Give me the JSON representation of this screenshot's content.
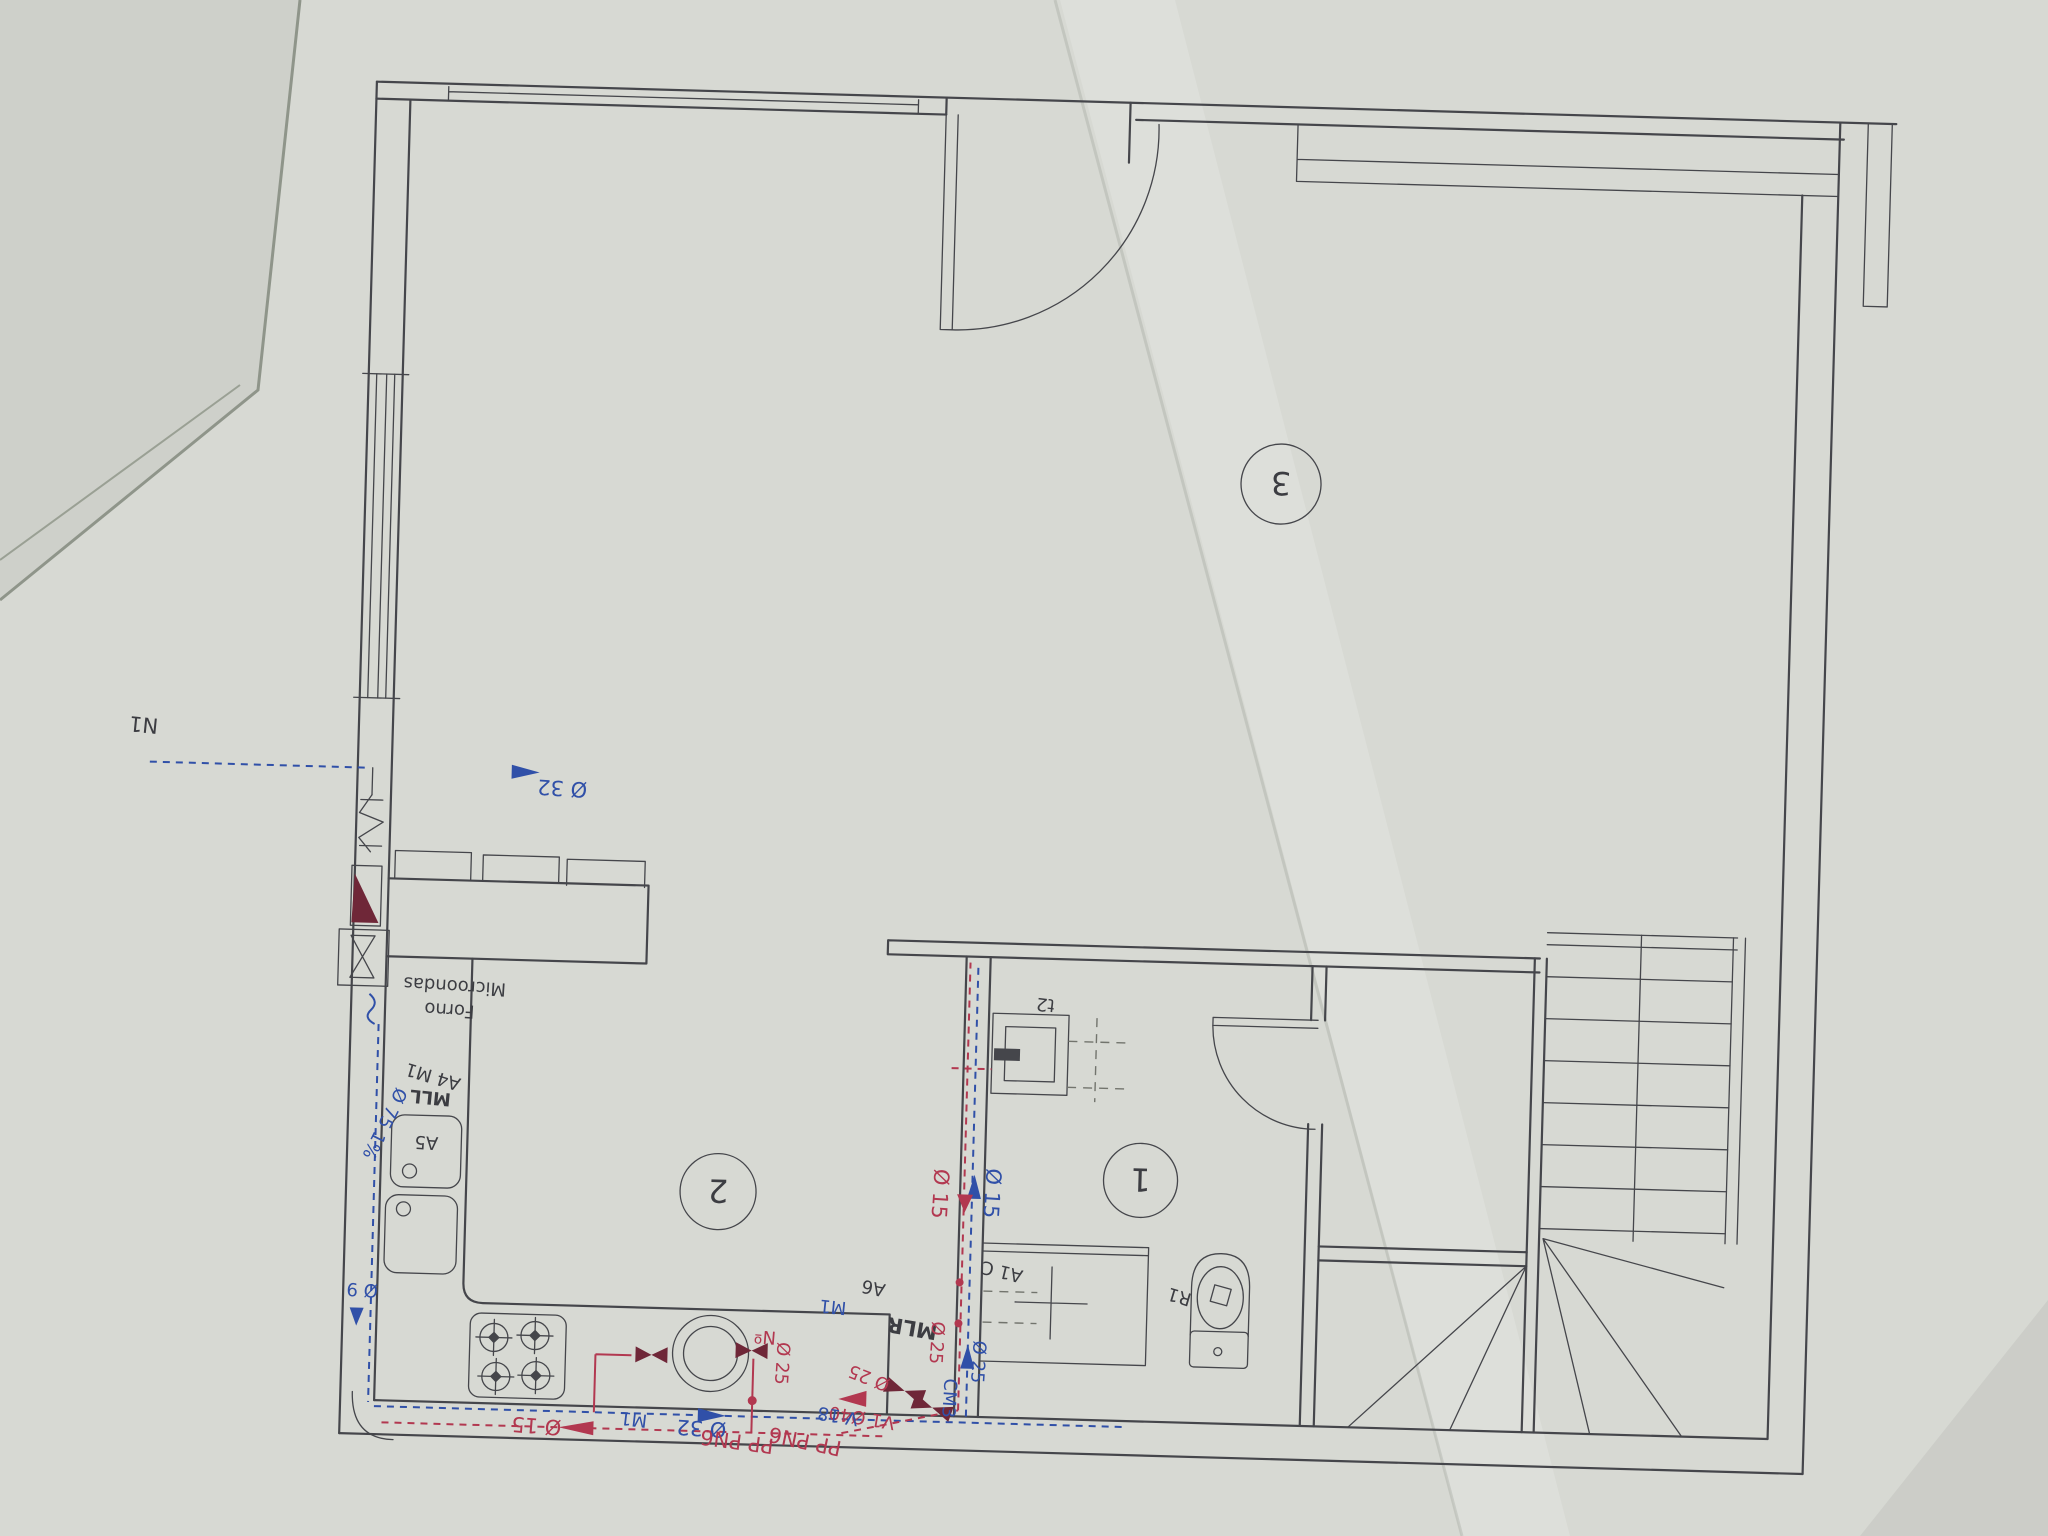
{
  "document": {
    "type": "photographed architectural floor plan, drawing appears rotated 180 degrees",
    "colors": {
      "paper": "#d7d9d3",
      "background": "#9aa094",
      "ink": "#45464b",
      "cold_water_blue": "#3050a8",
      "hot_water_red": "#b23850",
      "valve_dark_red": "#6f2738"
    }
  },
  "rooms": {
    "room1": "1",
    "room2": "2",
    "room3": "3"
  },
  "labels": {
    "n1": "N1",
    "d32_supply": "Ø 32",
    "forno": "Forno",
    "microondas": "Microondas",
    "a4_m1": "A4 M1",
    "mll": "MLL",
    "d75": "Ø 75 1%",
    "a5": "A5",
    "d9": "Ø 9",
    "d15_kitchen": "Ø 15",
    "m1_kitchen": "M1",
    "d32_kitchen": "Ø 32",
    "pp_pn6_1": "PP PN6",
    "pp_pn6_2": "PP PN6",
    "v1_d40": "V1 Ø40",
    "n_heater": "Nº",
    "d25_heater": "Ø 25",
    "m1_wall": "M1",
    "mlr": "MLR",
    "d25_hot": "Ø 25",
    "d25_cold": "Ø 25",
    "v18": "V 18",
    "cm3": "CM3",
    "d15_hot_riser": "Ø 15",
    "d15_cold_riser": "Ø 15",
    "a1c": "A1 C",
    "a6": "A6",
    "r1": "R1",
    "t2": "t2"
  }
}
